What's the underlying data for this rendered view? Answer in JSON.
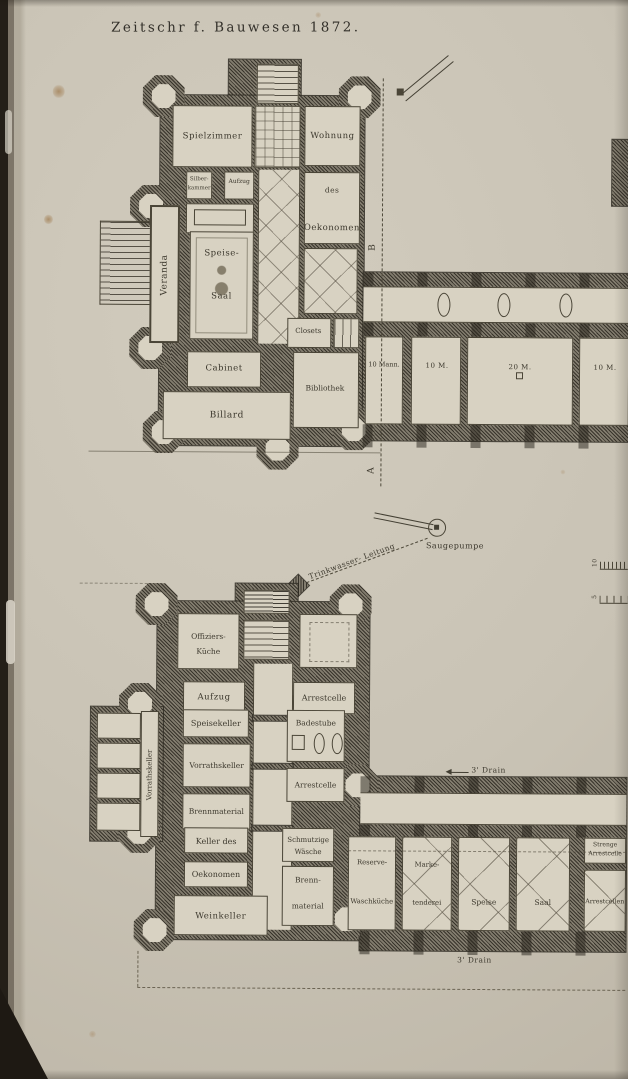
{
  "plate": {
    "title": "Zeitschr f. Bauwesen 1872."
  },
  "upper_plan": {
    "rooms": {
      "spielzimmer": "Spielzimmer",
      "wohnung": "Wohnung",
      "silber_1": "Silber-",
      "silber_2": "kammer",
      "aufzug": "Aufzug",
      "des": "des",
      "oekonomen": "Oekonomen",
      "speise_1": "Speise-",
      "speise_2": "Saal",
      "veranda": "Veranda",
      "closets": "Closets",
      "cabinet": "Cabinet",
      "bibliothek": "Bibliothek",
      "billard": "Billard"
    },
    "wing_rooms": [
      "10 Mann.",
      "10 M.",
      "20 M.",
      "10 M."
    ],
    "marker_b": "B",
    "marker_a": "A"
  },
  "waterworks": {
    "pump_label": "Saugepumpe",
    "pipe_label": "Trinkwasser- Leitung",
    "scale_top": "10",
    "scale_bottom": "5"
  },
  "lower_plan": {
    "rooms": {
      "offiziers_1": "Offiziers-",
      "offiziers_2": "Küche",
      "aufzug": "Aufzug",
      "arrestcelle_a": "Arrestcelle",
      "speisekeller": "Speisekeller",
      "badestube": "Badestube",
      "vorrathskeller_h": "Vorrathskeller",
      "arrestcelle_b": "Arrestcelle",
      "brennmaterial": "Brennmaterial",
      "keller_des": "Keller des",
      "oekonomen": "Oekonomen",
      "schmutzige_1": "Schmutzige",
      "schmutzige_2": "Wäsche",
      "weinkeller": "Weinkeller",
      "brenn_1": "Brenn-",
      "brenn_2": "material",
      "vorrathskeller_v": "Vorrathskeller"
    },
    "wing_rooms": {
      "reserve_1": "Reserve-",
      "reserve_2": "Waschküche",
      "marke_1": "Marke-",
      "marke_2": "tenderei",
      "speise": "Speise",
      "saal": "Saal",
      "strenge_1": "Strenge",
      "strenge_2": "Arrestcelle",
      "arrestcellen": "Arrestcellen"
    },
    "drain_top": "3' Drain",
    "drain_bottom": "3' Drain"
  }
}
